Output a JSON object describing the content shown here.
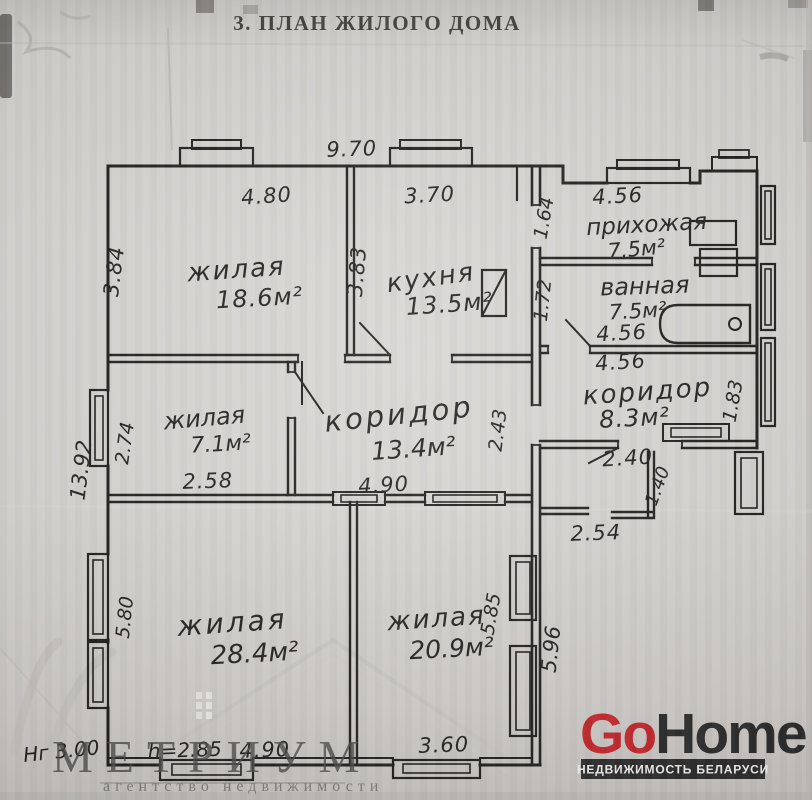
{
  "title": "3. ПЛАН ЖИЛОГО ДОМА",
  "rooms": {
    "living1": {
      "label": "жилая",
      "area": "18.6м²"
    },
    "kitchen": {
      "label": "кухня",
      "area": "13.5м²"
    },
    "hallway": {
      "label": "прихожая",
      "area": "7.5м²"
    },
    "bathroom": {
      "label": "ванная",
      "area": "7.5м²"
    },
    "corridor_small": {
      "label": "коридор",
      "area": "8.3м²"
    },
    "living2": {
      "label": "жилая",
      "area": "7.1м²"
    },
    "corridor_main": {
      "label": "коридор",
      "area": "13.4м²"
    },
    "living3": {
      "label": "жилая",
      "area": "28.4м²"
    },
    "living4": {
      "label": "жилая",
      "area": "20.9м²"
    }
  },
  "dimensions": {
    "house_width_top": "9.70",
    "living1_width": "4.80",
    "living1_depth": "3.84",
    "kitchen_width": "3.70",
    "kitchen_depth": "3.83",
    "hallway_width": "4.56",
    "hallway_depth": "1.64",
    "bathroom_depth": "1.72",
    "bathroom_width": "4.56",
    "corridor_small_width": "4.56",
    "corridor_small_depth": "1.83",
    "entry_width": "2.40",
    "entry_depth": "1.40",
    "porch_width": "2.54",
    "living2_width": "2.58",
    "living2_depth": "2.74",
    "corridor_main_width": "4.90",
    "corridor_main_depth": "2.43",
    "house_depth_left": "13.92",
    "living3_depth": "5.80",
    "living4_depth_inner": "5.85",
    "living4_depth_outer": "5.96",
    "living3_width": "4.90",
    "living4_width": "3.60",
    "ceiling_height_note": "h=2.85",
    "height_note": "Нг 3.00"
  },
  "watermark": {
    "agency": "МЕТРИУМ",
    "tagline": "агентство недвижимости"
  },
  "logo": {
    "go": "Go",
    "home": "Home",
    "tagline": "НЕДВИЖИМОСТЬ БЕЛАРУСИ"
  },
  "colors": {
    "ink": "#201f1d",
    "paper": "#d7d5d2",
    "logo_accent": "#c4272c",
    "logo_dark": "#2e2d2d",
    "watermark_gray": "#4a4947"
  }
}
